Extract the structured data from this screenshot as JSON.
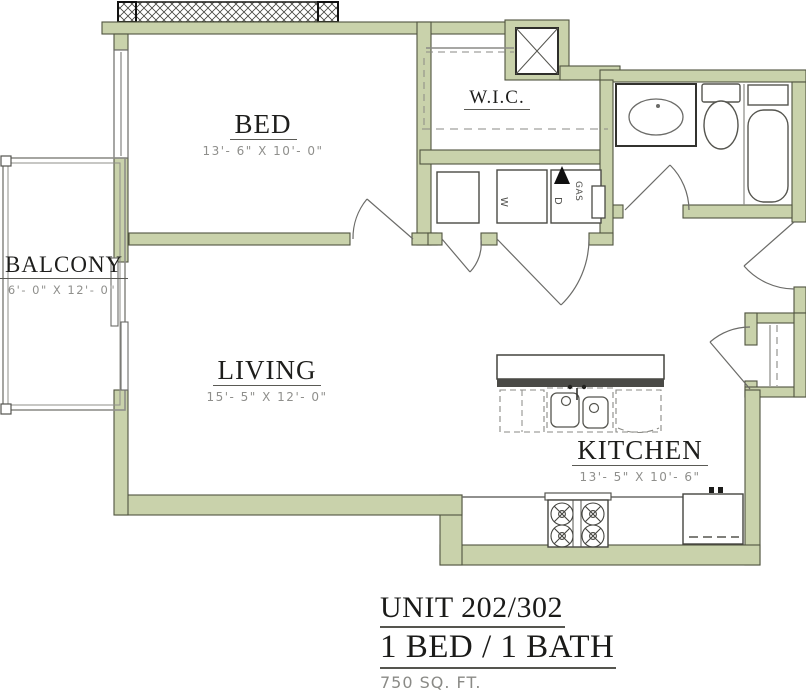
{
  "plan": {
    "rooms": {
      "bed": {
        "name": "BED",
        "dims": "13'- 6\" X 10'- 0\""
      },
      "wic": {
        "name": "W.I.C."
      },
      "balcony": {
        "name": "BALCONY",
        "dims": "6'- 0\" X 12'- 0\""
      },
      "living": {
        "name": "LIVING",
        "dims": "15'- 5\" X 12'- 0\""
      },
      "kitchen": {
        "name": "KITCHEN",
        "dims": "13'- 5\" X 10'- 6\""
      }
    },
    "labels": {
      "washer": "W",
      "dryer": "D",
      "gas": "GAS"
    }
  },
  "title_block": {
    "unit": "UNIT 202/302",
    "config": "1 BED / 1 BATH",
    "area": "750 SQ. FT."
  },
  "colors": {
    "wall_fill": "#c9d2ab",
    "wall_stroke": "#50543f",
    "line_gray": "#6b6b68",
    "text_dark": "#1e1e1c",
    "dim_gray": "#8f8f8c"
  }
}
